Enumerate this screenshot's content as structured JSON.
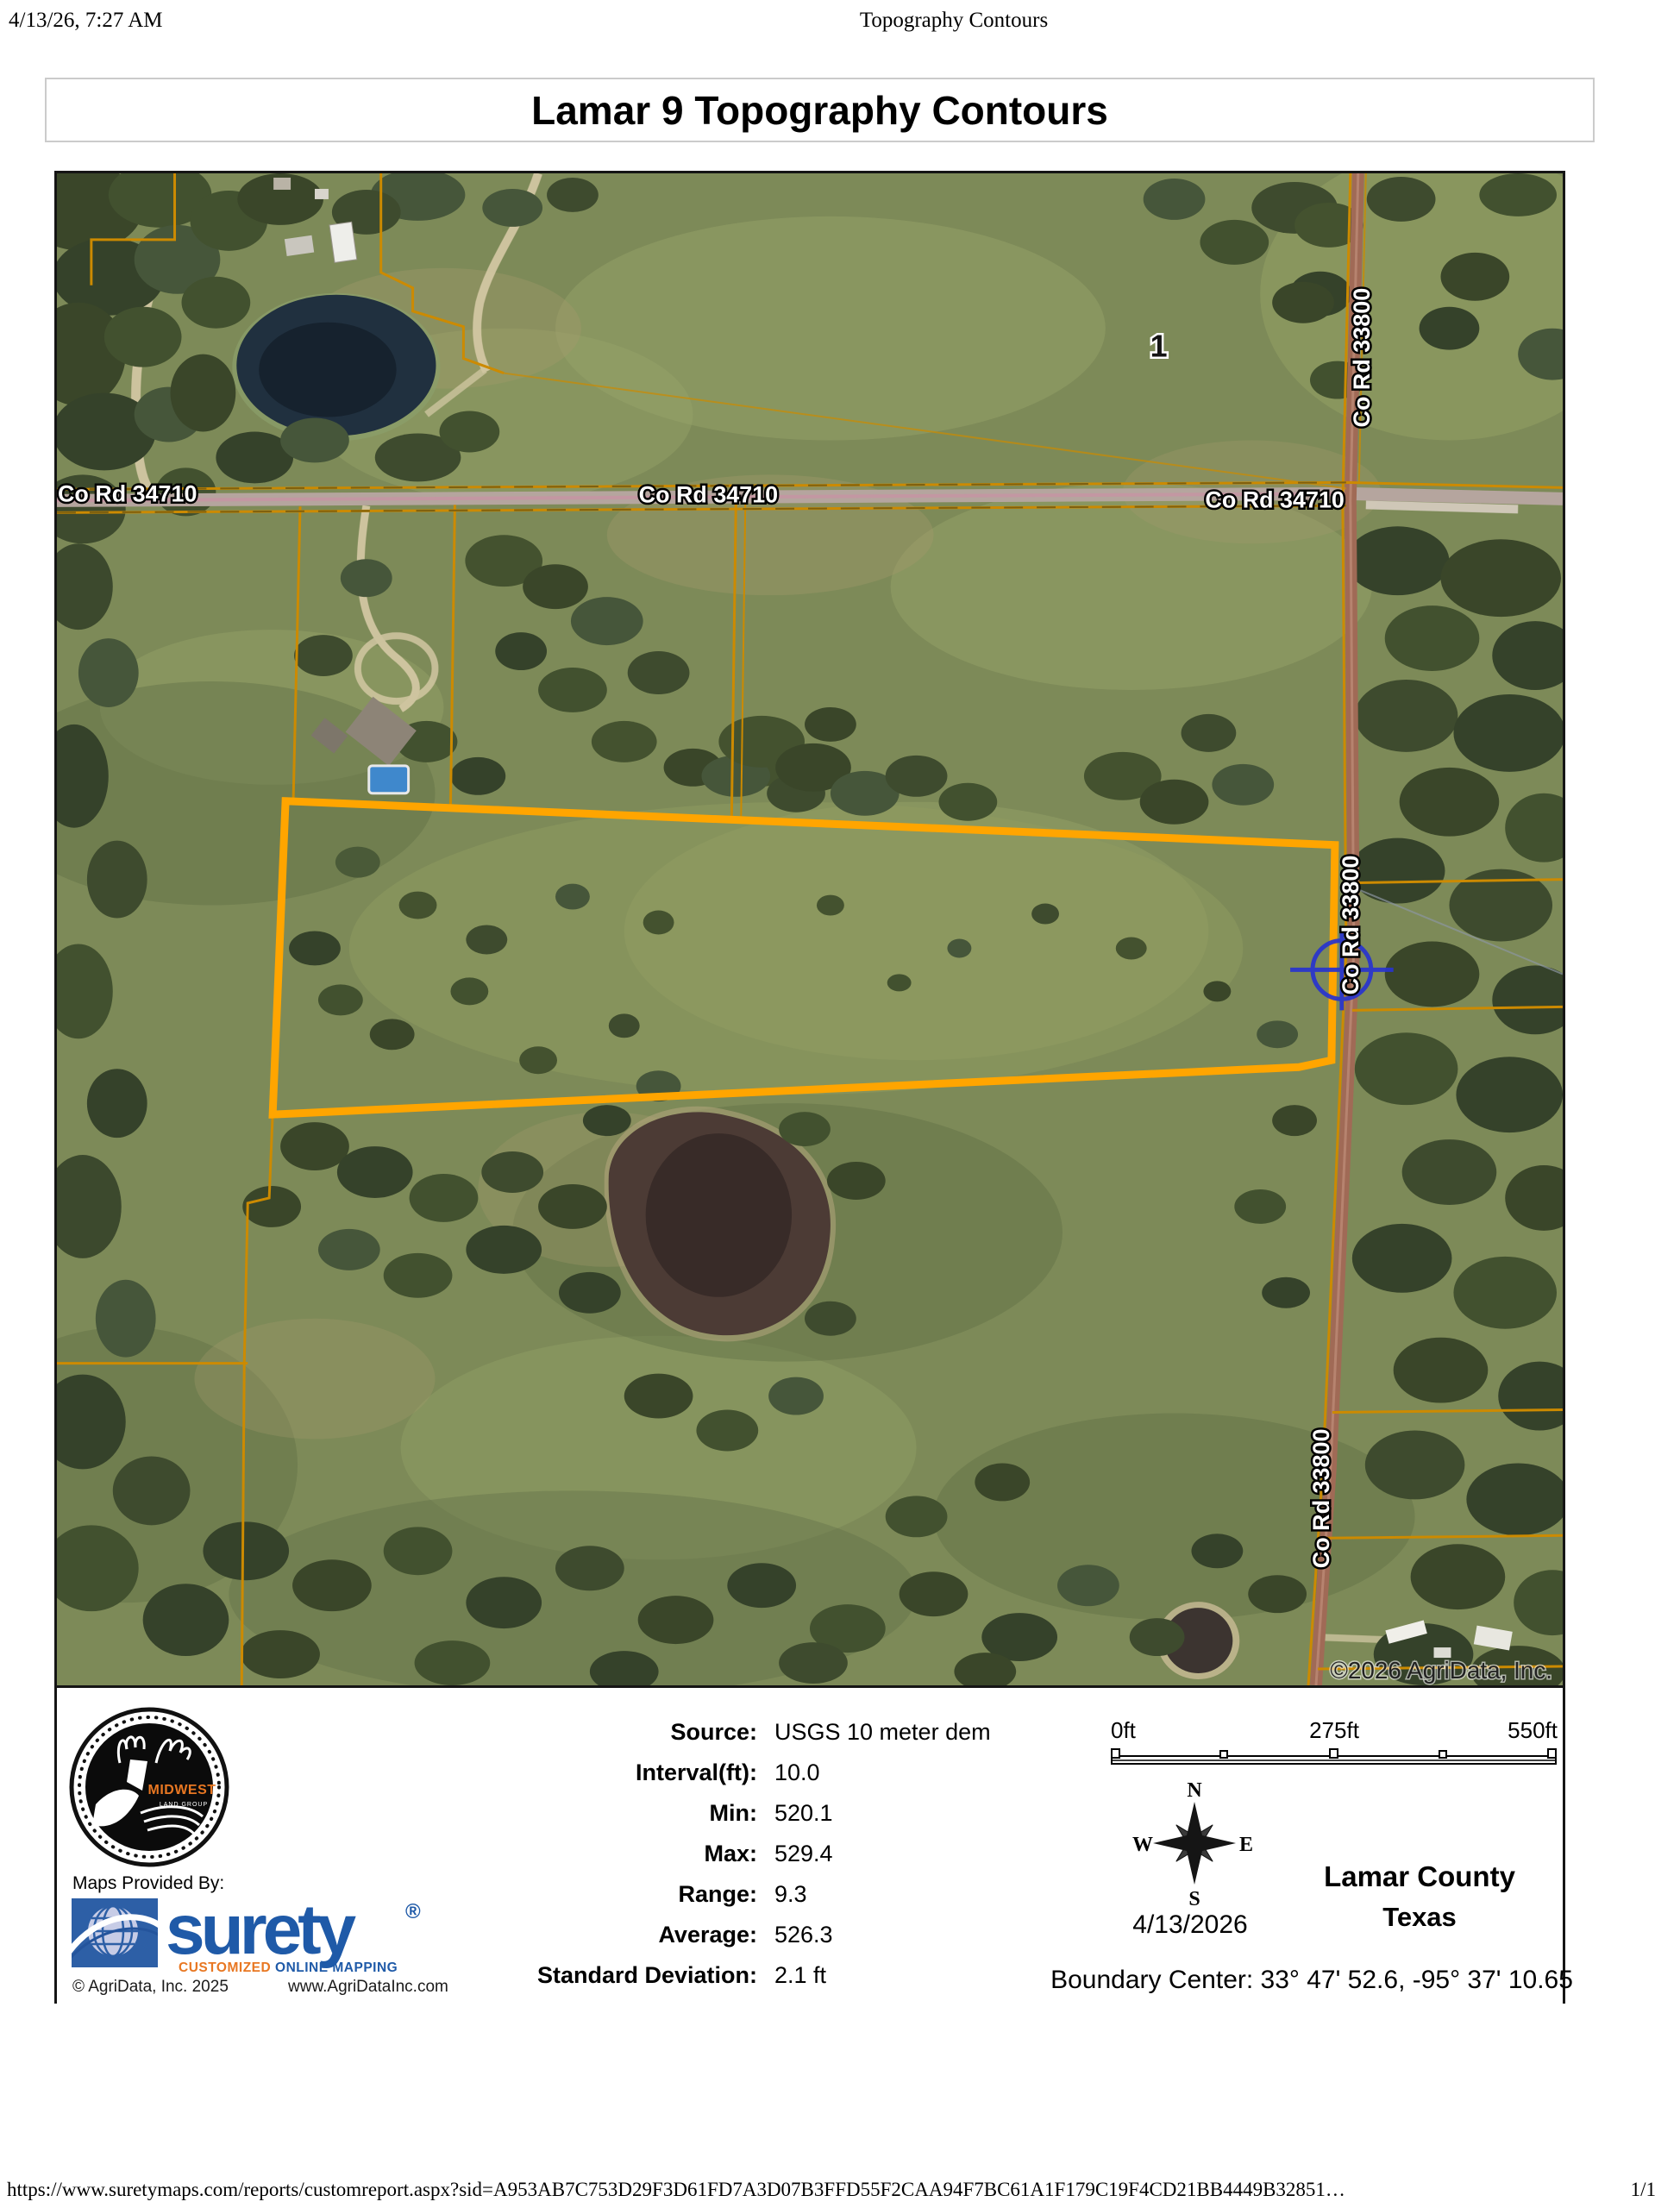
{
  "page": {
    "header": {
      "printed_at": "4/13/26, 7:27 AM",
      "document_title": "Topography Contours"
    },
    "footer": {
      "url": "https://www.suretymaps.com/reports/customreport.aspx?sid=A953AB7C753D29F3D61FD7A3D07B3FFD55F2CAA94F7BC61A1F179C19F4CD21BB4449B32851…",
      "page_indicator": "1/1"
    }
  },
  "report": {
    "title": "Lamar 9 Topography Contours"
  },
  "map": {
    "road_label_34710": "Co Rd 34710",
    "road_label_33800": "Co Rd 33800",
    "parcel_number": "1",
    "copyright": "©2026 AgriData, Inc.",
    "colors": {
      "highlighted_parcel_boundary": "#FFA500",
      "parcel_boundary_lines": "#CC8A00",
      "crosshair_marker": "#2834CF"
    }
  },
  "legend": {
    "stats": {
      "rows": [
        {
          "label": "Source:",
          "value": "USGS 10 meter dem"
        },
        {
          "label": "Interval(ft):",
          "value": "10.0"
        },
        {
          "label": "Min:",
          "value": "520.1"
        },
        {
          "label": "Max:",
          "value": "529.4"
        },
        {
          "label": "Range:",
          "value": "9.3"
        },
        {
          "label": "Average:",
          "value": "526.3"
        },
        {
          "label": "Standard Deviation:",
          "value": "2.1 ft"
        }
      ]
    },
    "scale_bar": {
      "start": "0ft",
      "middle": "275ft",
      "end": "550ft"
    },
    "compass": {
      "north": "N",
      "east": "E",
      "south": "S",
      "west": "W"
    },
    "map_date": "4/13/2026",
    "county": "Lamar County",
    "state": "Texas",
    "boundary_center": "Boundary Center: 33° 47' 52.6, -95° 37' 10.65",
    "provider": {
      "maps_provided_by": "Maps Provided By:",
      "midwest_logo_title": "MIDWEST",
      "midwest_logo_subtitle": "LAND GROUP",
      "surety_brand": "surety",
      "surety_registered": "®",
      "surety_tagline_customized": "CUSTOMIZED",
      "surety_tagline_online_mapping": " ONLINE MAPPING",
      "agridata_copyright": "© AgriData, Inc. 2025",
      "agridata_website": "www.AgriDataInc.com"
    }
  }
}
